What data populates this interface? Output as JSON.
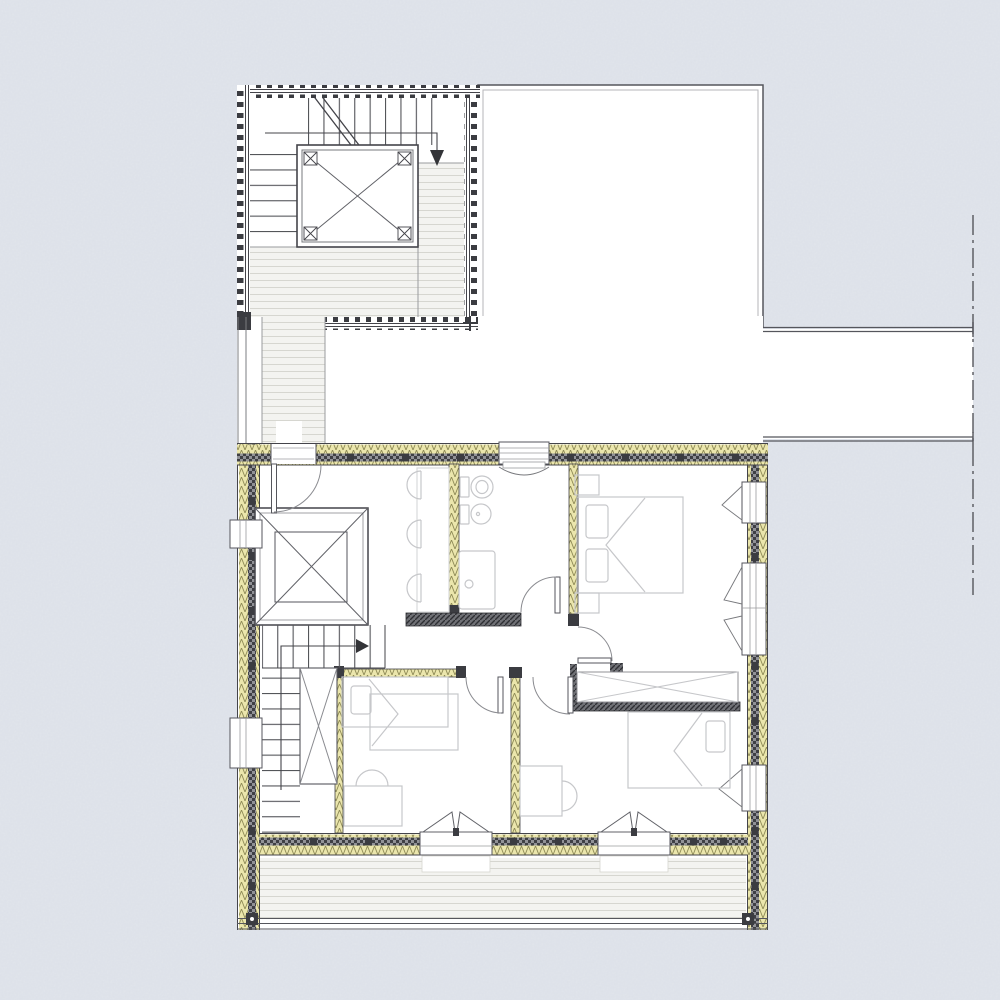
{
  "canvas": {
    "width": 1000,
    "height": 1000
  },
  "meta": {
    "drawing_type": "architectural floor plan",
    "visible_text": []
  },
  "palette": {
    "background": "#e1e5ec",
    "paper": "#ffffff",
    "line": "#44444a",
    "mid_line": "#8a8b90",
    "light_line": "#b5b6ba",
    "furniture": "#c6c7ca",
    "deck_fill": "#f3f3f0",
    "deck_line": "#d6d6d0",
    "insulation_fill": "#ebe6ac",
    "insulation_hatch": "#8e8a56",
    "batten_fill": "#919297",
    "batten_dark": "#3f4045",
    "dark_wall": "#6f7075",
    "boundary": "#55565c"
  },
  "plan": {
    "areas": [
      {
        "name": "roof-terrace-stair-block"
      },
      {
        "name": "adjacent-roof-outline"
      },
      {
        "name": "connecting-walkway"
      },
      {
        "name": "main-floor"
      },
      {
        "name": "balcony"
      }
    ],
    "stairs": [
      {
        "name": "terrace-stair",
        "direction_arrow": "down"
      },
      {
        "name": "main-stair",
        "direction_arrow": "right"
      }
    ],
    "skylights": 2,
    "rooms": [
      {
        "name": "landing",
        "furniture": [
          "counter",
          "chair",
          "chair",
          "chair"
        ]
      },
      {
        "name": "bathroom",
        "fixtures": [
          "toilet",
          "bidet",
          "shower"
        ]
      },
      {
        "name": "bedroom-top-right",
        "furniture": [
          "double-bed",
          "nightstand",
          "nightstand",
          "wardrobe"
        ]
      },
      {
        "name": "bedroom-bottom-left",
        "furniture": [
          "single-bed",
          "desk",
          "chair"
        ]
      },
      {
        "name": "bedroom-bottom-right",
        "furniture": [
          "single-bed",
          "desk",
          "chair"
        ]
      }
    ],
    "openings": {
      "entrance_doors": 1,
      "interior_doors": 4,
      "french_doors_to_balcony": 2,
      "windows_left_wall": 2,
      "windows_right_wall": 3,
      "windows_top_wall": 1
    }
  }
}
